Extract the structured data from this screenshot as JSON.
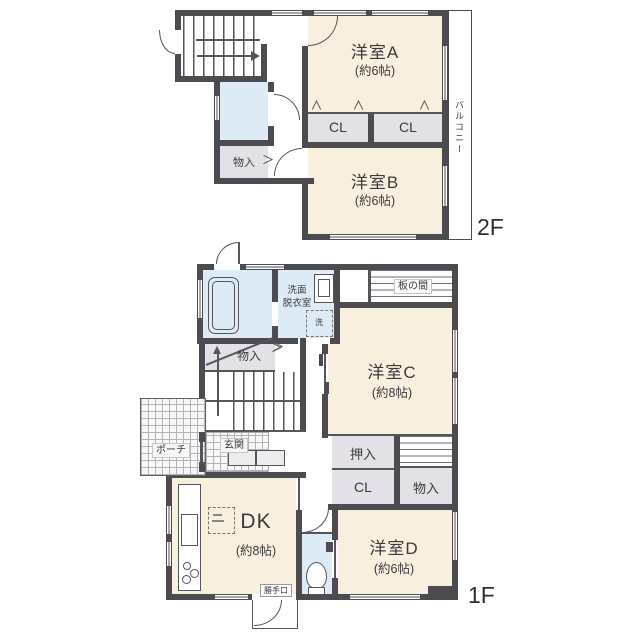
{
  "colors": {
    "wall": "#4b4b50",
    "room_fill": "#f9efdf",
    "closet_fill": "#e4e0e8",
    "wet_area_fill": "#dcebf5",
    "text": "#3a3a3e"
  },
  "floor_2f": {
    "floor_label": "2F",
    "room_a_name": "洋室A",
    "room_a_size": "(約6帖)",
    "room_b_name": "洋室B",
    "room_b_size": "(約6帖)",
    "closet_1": "CL",
    "closet_2": "CL",
    "storage": "物入",
    "balcony": "バルコニー"
  },
  "floor_1f": {
    "floor_label": "1F",
    "room_c_name": "洋室C",
    "room_c_size": "(約8帖)",
    "room_d_name": "洋室D",
    "room_d_size": "(約6帖)",
    "dk_name": "DK",
    "dk_size": "(約8帖)",
    "washroom_line1": "洗面",
    "washroom_line2": "脱衣室",
    "washer": "洗",
    "itanoma": "板の間",
    "oshiire": "押入",
    "closet": "CL",
    "storage_right": "物入",
    "storage_stairs": "物入",
    "entrance": "玄関",
    "porch": "ポーチ",
    "back_door": "勝手口"
  }
}
